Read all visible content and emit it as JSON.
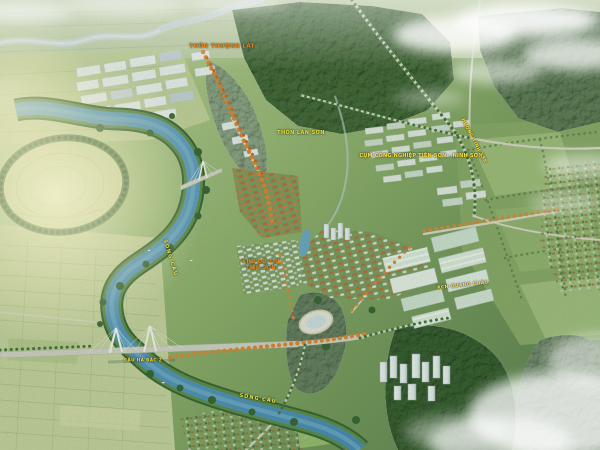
{
  "labels": {
    "village_top": "THÔN THƯỢNG LÁT",
    "village_mid": "THÔN LÁN SƠN",
    "industrial_cluster": "CỤM CÔNG NGHIỆP TIÊN SƠN - NINH SƠN",
    "road": "ĐƯỜNG TỈNH 398",
    "urban_line1": "KHU ĐÔ THỊ",
    "urban_line2": "TIÊN SƠN",
    "river_upper": "SÔNG CẦU",
    "river_lower": "SÔNG CẦU",
    "bridge": "CẦU HÀ BẮC 2",
    "industrial_park": "KCN QUANG CHÂU"
  },
  "colors": {
    "river": "#4a8ebf",
    "forest": "#3d6233",
    "fields": "#c6d09e",
    "orange_trees": "#e07f2c",
    "orange_roofs": "#c05f2e",
    "warehouse_white": "#eef2f4",
    "label_yellow": "#ffe23e",
    "label_orange": "#f08a1c"
  }
}
